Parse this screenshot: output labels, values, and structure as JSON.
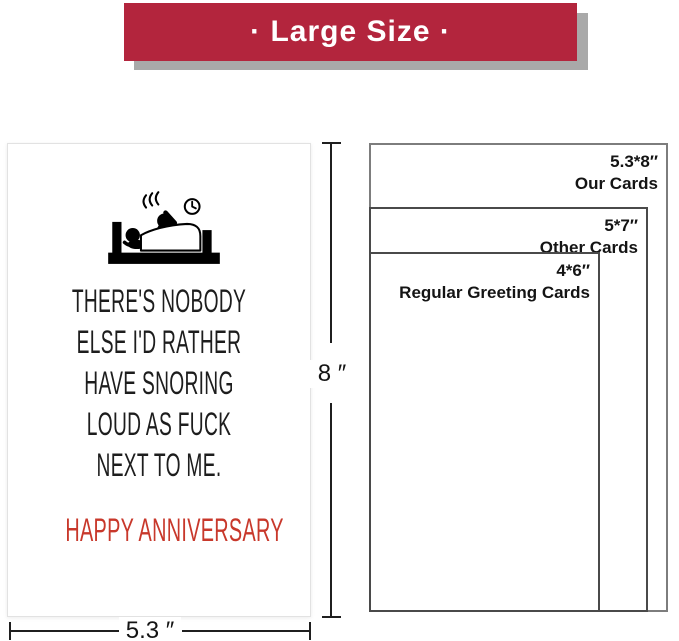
{
  "banner": {
    "label": "· Large Size ·",
    "background_color": "#b3253d",
    "shadow_color": "#a9a9a9",
    "text_color": "#ffffff"
  },
  "card": {
    "illustration": "couple-in-bed-snoring-pictogram-with-clock",
    "message_lines": [
      "THERE'S NOBODY",
      "ELSE I'D RATHER",
      "HAVE SNORING",
      "LOUD AS FUCK",
      "NEXT TO ME."
    ],
    "message_color": "#1d1d1d",
    "greeting": "HAPPY ANNIVERSARY",
    "greeting_color": "#c8382b"
  },
  "measurements": {
    "height_label": "8 ″",
    "width_label": "5.3 ″"
  },
  "size_comparison": {
    "items": [
      {
        "size": "5.3*8″",
        "label": "Our Cards"
      },
      {
        "size": "5*7″",
        "label": "Other Cards"
      },
      {
        "size": "4*6″",
        "label": "Regular Greeting Cards"
      }
    ]
  },
  "icons": {
    "bed": "bed-icon",
    "sleeping_person": "sleeping-person-icon",
    "snoring_person": "snoring-person-icon",
    "snore_marks": "snore-marks-icon",
    "clock": "clock-icon"
  }
}
